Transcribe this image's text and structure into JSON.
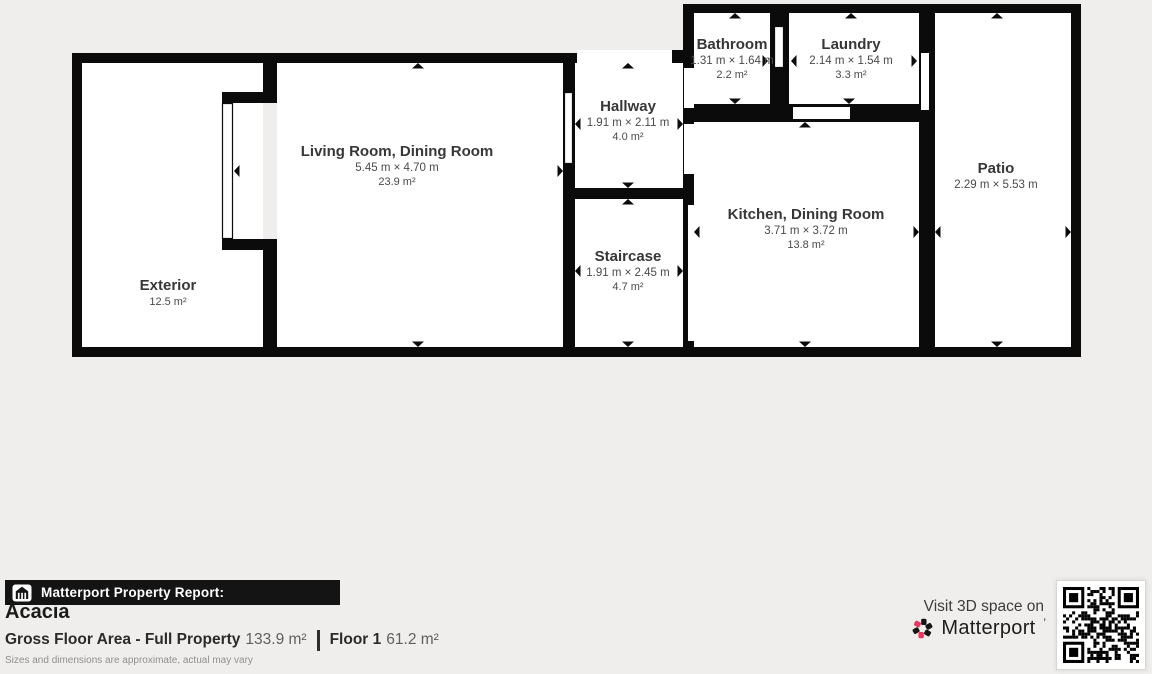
{
  "colors": {
    "background": "#efeeec",
    "wall": "#0b0b0b",
    "room_fill": "#ffffff",
    "accent_pink": "#e8365f",
    "bar_black": "#141414"
  },
  "plan": {
    "rooms": [
      {
        "id": "bathroom",
        "label": "Bathroom",
        "dims": "1.31 m × 1.64 m",
        "area": "2.2 m²",
        "cx": 732,
        "cy": 45
      },
      {
        "id": "laundry",
        "label": "Laundry",
        "dims": "2.14 m × 1.54 m",
        "area": "3.3 m²",
        "cx": 851,
        "cy": 45
      },
      {
        "id": "hallway",
        "label": "Hallway",
        "dims": "1.91 m × 2.11 m",
        "area": "4.0 m²",
        "cx": 628,
        "cy": 107
      },
      {
        "id": "living-room-dining-room",
        "label": "Living Room, Dining Room",
        "dims": "5.45 m × 4.70 m",
        "area": "23.9 m²",
        "cx": 397,
        "cy": 152
      },
      {
        "id": "patio",
        "label": "Patio",
        "dims": "2.29 m × 5.53 m",
        "area": "",
        "cx": 996,
        "cy": 169
      },
      {
        "id": "kitchen-dining-room",
        "label": "Kitchen, Dining Room",
        "dims": "3.71 m × 3.72 m",
        "area": "13.8 m²",
        "cx": 806,
        "cy": 215
      },
      {
        "id": "staircase",
        "label": "Staircase",
        "dims": "1.91 m × 2.45 m",
        "area": "4.7 m²",
        "cx": 628,
        "cy": 257
      },
      {
        "id": "exterior",
        "label": "Exterior",
        "dims": "",
        "area": "12.5 m²",
        "cx": 168,
        "cy": 286
      }
    ]
  },
  "footer": {
    "report_title": "Matterport Property Report:",
    "property_name": "Acacia",
    "gfa_label": "Gross Floor Area - Full Property",
    "gfa_value": "133.9 m²",
    "floor_label": "Floor 1",
    "floor_value": "61.2 m²",
    "disclaimer": "Sizes and dimensions are approximate, actual may vary",
    "visit_text": "Visit 3D space on",
    "brand": "Matterport",
    "brand_mark": "’"
  },
  "icons": {
    "property_icon": "house-with-columns",
    "brand_icon": "matterport-pinwheel",
    "qr": "qr-code"
  }
}
